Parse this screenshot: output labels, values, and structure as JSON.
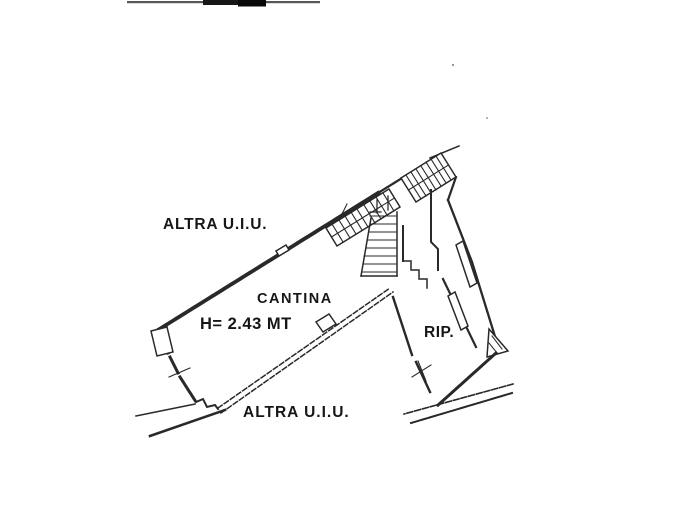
{
  "plan": {
    "labels": {
      "area_top": "ALTRA U.I.U.",
      "main_room": "CANTINA",
      "ceiling_height": "H= 2.43 MT",
      "storage_room": "RIP.",
      "area_bottom": "ALTRA U.I.U."
    },
    "colors": {
      "wall_line": "#2e2e2e",
      "label_text": "#161616",
      "background": "#ffffff"
    }
  }
}
